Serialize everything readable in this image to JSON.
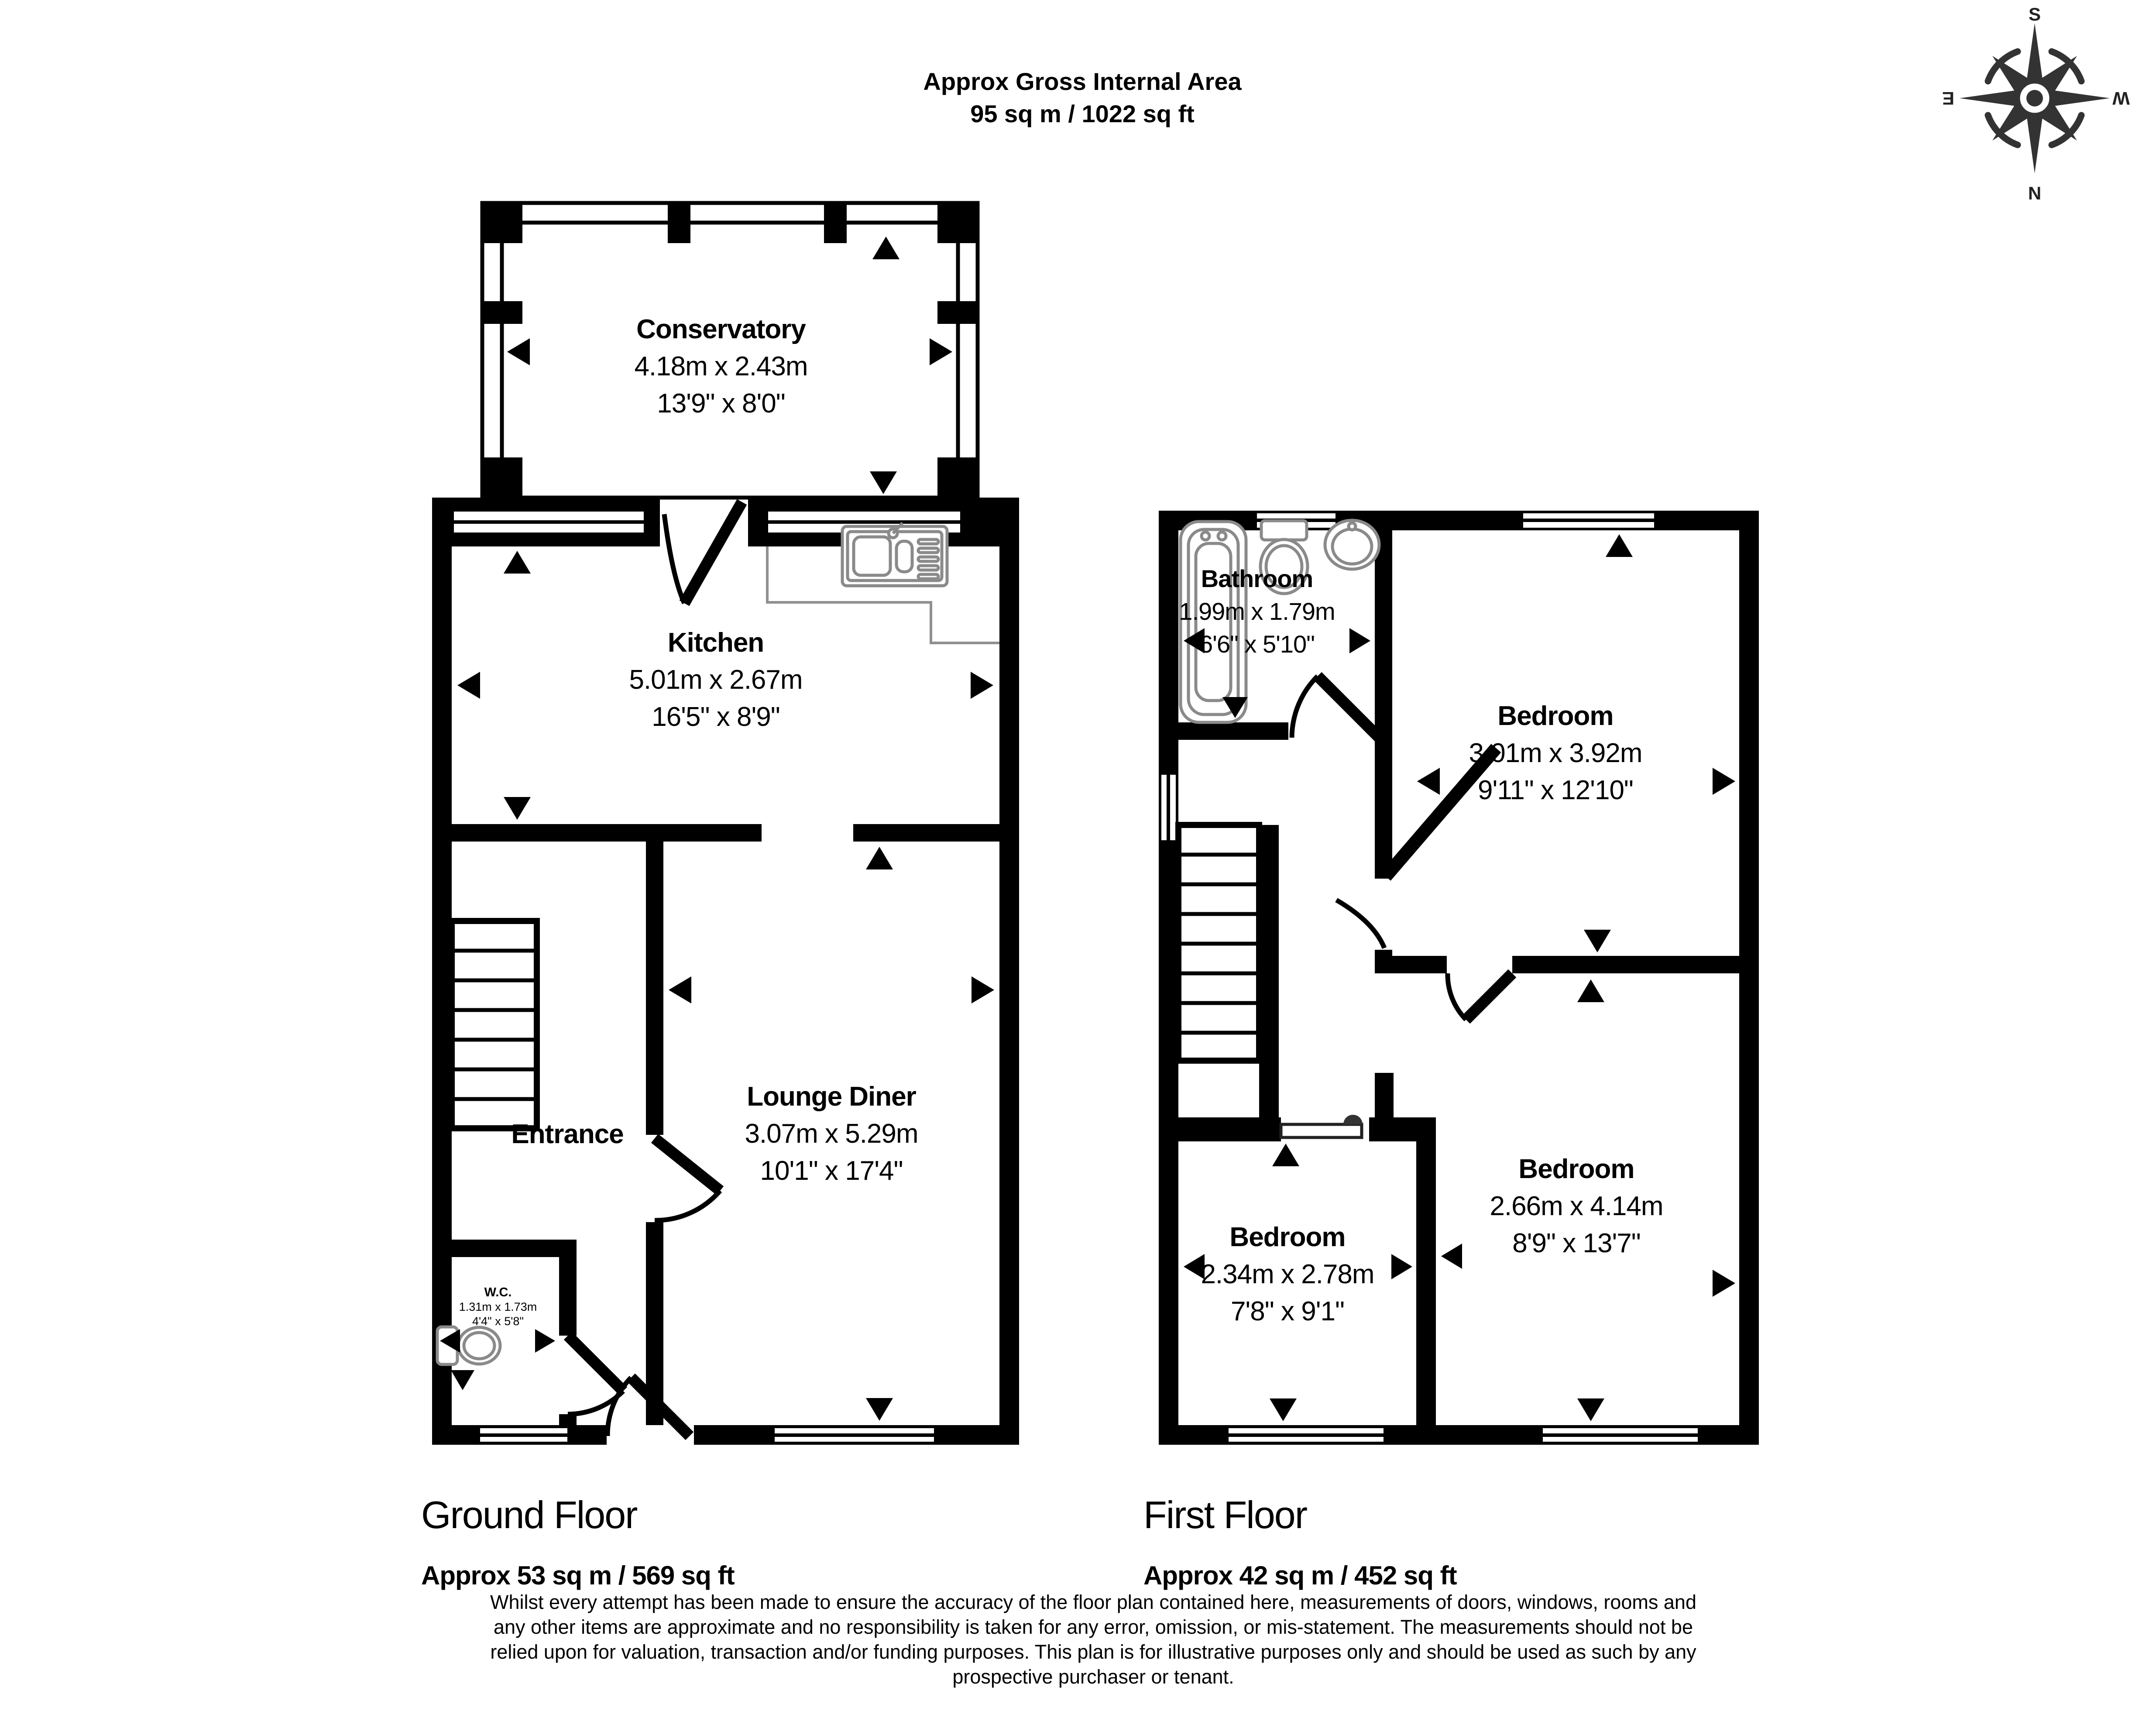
{
  "header": {
    "title": "Approx Gross Internal Area",
    "area": "95 sq m / 1022 sq ft"
  },
  "compass": {
    "n": "N",
    "s": "S",
    "e": "E",
    "w": "W"
  },
  "ground_floor": {
    "heading": "Ground Floor",
    "area": "Approx 53 sq m / 569 sq ft",
    "rooms": {
      "conservatory": {
        "name": "Conservatory",
        "metric": "4.18m x 2.43m",
        "imperial": "13'9\" x 8'0\""
      },
      "kitchen": {
        "name": "Kitchen",
        "metric": "5.01m x 2.67m",
        "imperial": "16'5\" x 8'9\""
      },
      "lounge_diner": {
        "name": "Lounge Diner",
        "metric": "3.07m x 5.29m",
        "imperial": "10'1\" x 17'4\""
      },
      "entrance": {
        "name": "Entrance"
      },
      "wc": {
        "name": "W.C.",
        "metric": "1.31m x 1.73m",
        "imperial": "4'4\" x 5'8\""
      }
    }
  },
  "first_floor": {
    "heading": "First Floor",
    "area": "Approx 42 sq m / 452 sq ft",
    "rooms": {
      "bathroom": {
        "name": "Bathroom",
        "metric": "1.99m x 1.79m",
        "imperial": "6'6\" x 5'10\""
      },
      "bedroom_1": {
        "name": "Bedroom",
        "metric": "3.01m x 3.92m",
        "imperial": "9'11\" x 12'10\""
      },
      "bedroom_2": {
        "name": "Bedroom",
        "metric": "2.34m x 2.78m",
        "imperial": "7'8\" x 9'1\""
      },
      "bedroom_3": {
        "name": "Bedroom",
        "metric": "2.66m x 4.14m",
        "imperial": "8'9\" x 13'7\""
      }
    }
  },
  "disclaimer": {
    "lines": [
      "Whilst every attempt has been made to ensure the accuracy of the floor plan contained here, measurements of doors, windows, rooms and",
      "any other items are approximate and no responsibility is taken for any error, omission, or mis-statement. The measurements should not be",
      "relied upon for valuation, transaction and/or funding purposes. This plan is for illustrative purposes only and should be used as such by any",
      "prospective purchaser or tenant."
    ]
  },
  "colors": {
    "wall": "#000000",
    "fixture": "#8a8a8a",
    "background": "#ffffff"
  }
}
